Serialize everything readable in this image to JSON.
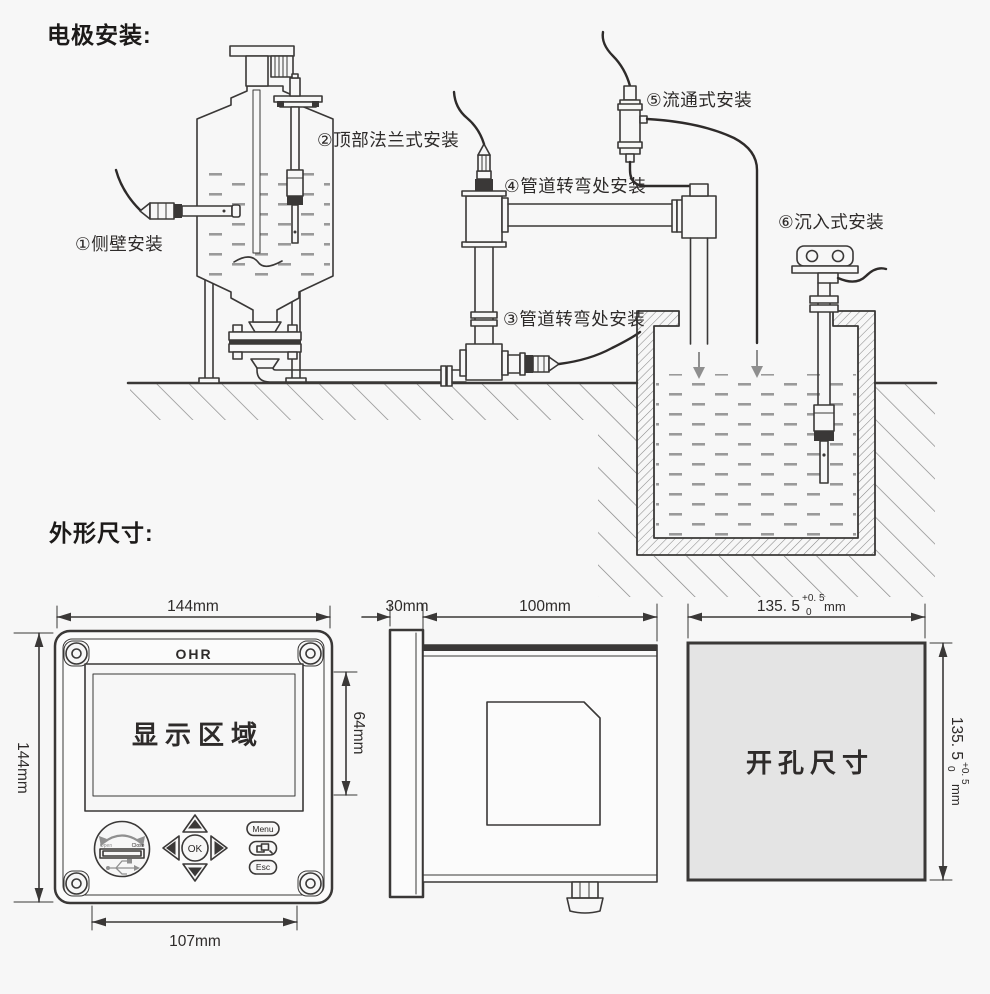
{
  "titles": {
    "electrode_installation": "电极安装:",
    "outline_dimensions": "外形尺寸:"
  },
  "installation": {
    "labels": [
      {
        "text": "①侧壁安装"
      },
      {
        "text": "②顶部法兰式安装"
      },
      {
        "text": "③管道转弯处安装"
      },
      {
        "text": "④管道转弯处安装"
      },
      {
        "text": "⑤流通式安装"
      },
      {
        "text": "⑥沉入式安装"
      }
    ]
  },
  "front_view": {
    "brand": "OHR",
    "display_area_label": "显示区域",
    "usb_cover": {
      "open_label": "Open",
      "close_label": "Close"
    },
    "keys": {
      "ok": "OK",
      "menu": "Menu",
      "esc": "Esc"
    },
    "dimensions": {
      "width": "144mm",
      "height": "144mm",
      "display_height": "64mm",
      "mount_width": "107mm"
    }
  },
  "side_view": {
    "dimensions": {
      "bezel_depth": "30mm",
      "body_depth": "100mm"
    }
  },
  "cutout_view": {
    "label": "开孔尺寸",
    "dimension": {
      "value": "135. 5",
      "tolerance_upper": "+0. 5",
      "tolerance_lower": "0",
      "unit": "mm"
    }
  },
  "colors": {
    "background": "#f7f7f7",
    "line": "#3a3837",
    "hatch": "#8a8a8a",
    "cutout_fill": "#e4e4e4"
  }
}
